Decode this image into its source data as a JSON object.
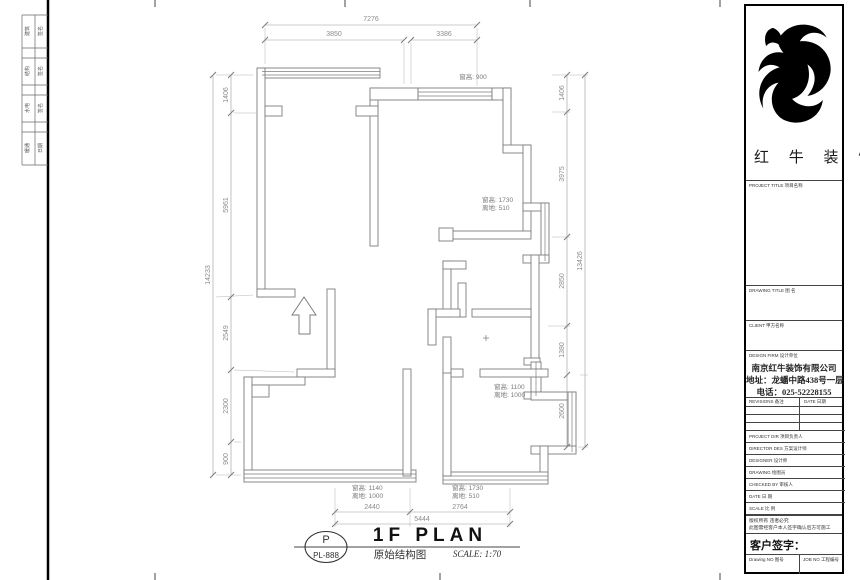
{
  "sheet": {
    "type": "architectural floor plan drawing",
    "colors": {
      "wall_line": "#7d7d7d",
      "dim_line": "#9a9a9a",
      "dim_text": "#8c8c8c",
      "title_text": "#111111",
      "block_border": "#000000"
    }
  },
  "dimensions": {
    "top": {
      "overall": "7276",
      "segments": [
        "3850",
        "3386"
      ]
    },
    "left": {
      "overall": "14233",
      "segments": [
        "1406",
        "5961",
        "2549",
        "2300",
        "900"
      ]
    },
    "right": {
      "overall": "13426",
      "segments": [
        "1406",
        "3975",
        "2850",
        "1380",
        "2600"
      ]
    },
    "bottom": {
      "overall": "5444",
      "segments": [
        "2440",
        "2764"
      ]
    }
  },
  "plan_labels": [
    {
      "lines": [
        "窗高: 900",
        ""
      ]
    },
    {
      "lines": [
        "窗高: 1730",
        "离地: 510"
      ]
    },
    {
      "lines": [
        "窗高: 1100",
        "离地: 1000"
      ]
    },
    {
      "lines": [
        "窗高: 1140",
        "离地: 1000"
      ]
    },
    {
      "lines": [
        "窗高: 1730",
        "离地: 510"
      ]
    }
  ],
  "drawing_title": {
    "tag_top": "P",
    "tag_bottom": "PL-888",
    "title": "1F PLAN",
    "subtitle": "原始结构图",
    "scale": "SCALE: 1:70"
  },
  "title_block": {
    "brand": "红 牛 装 饰",
    "project_title_label": "PROJECT TITLE 项目名称",
    "drawing_title_label": "DRAWING TITLE 图 名",
    "client_label": "CLIENT 甲方名称",
    "design_firm_label": "DESIGN FIRM 设计单位",
    "company_name": "南京红牛装饰有限公司",
    "company_address": "地址：龙蟠中路438号一层",
    "company_phone": "电话：025-52228155",
    "revisions_label": "REVISIONS 备注",
    "date_col_label": "DATE 日期",
    "rows": [
      {
        "label": "PROJECT DIR  项目负责人"
      },
      {
        "label": "DIRECTOR DES  方案设计师"
      },
      {
        "label": "DESIGNER  设计师"
      },
      {
        "label": "DRAWING  绘图员"
      },
      {
        "label": "CHECKED BY  审核人"
      },
      {
        "label": "DATE  日 期"
      },
      {
        "label": "SCALE  比 例"
      }
    ],
    "notice_line1": "版权所有 违者必究",
    "notice_line2": "此图需经客户本人签字确认后方可施工",
    "signature_label": "客户签字：",
    "drawing_no_label": "Drawing NO 图号",
    "job_no_label": "JOB NO 工程编号"
  },
  "binding_strip": {
    "cells": [
      "建筑",
      "签名",
      "结构",
      "签名",
      "水电",
      "签名",
      "暖通",
      "日期"
    ]
  }
}
